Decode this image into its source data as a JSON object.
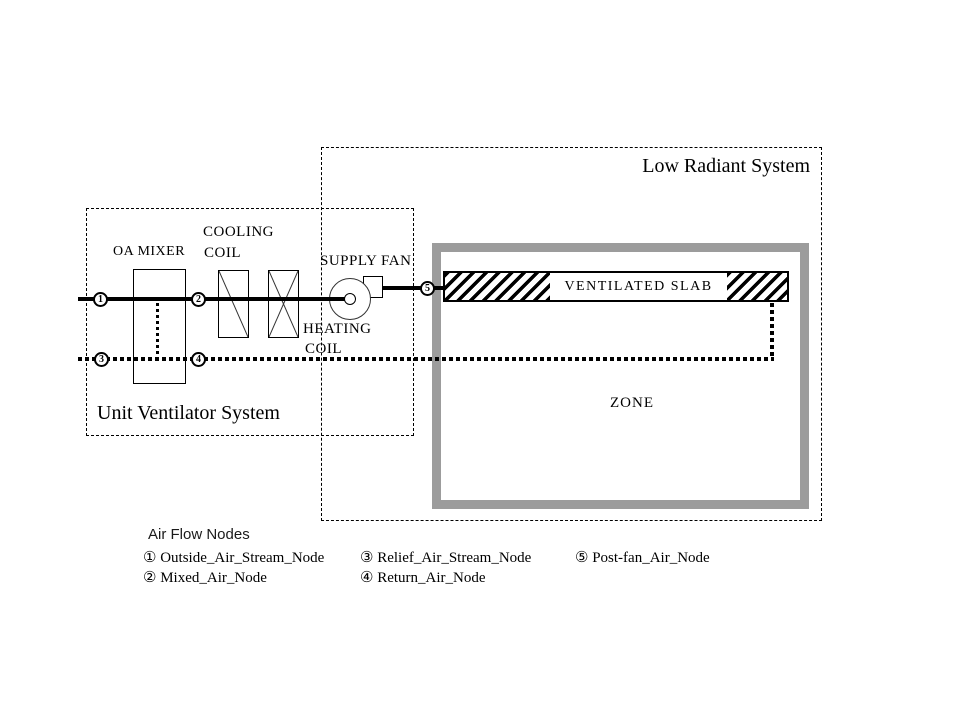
{
  "diagram": {
    "low_radiant_title": "Low Radiant System",
    "unit_ventilator_title": "Unit Ventilator System",
    "labels": {
      "oa_mixer": "OA MIXER",
      "cooling_line1": "COOLING",
      "cooling_line2": "COIL",
      "heating_line1": "HEATING",
      "heating_line2": "COIL",
      "supply_fan": "SUPPLY FAN",
      "ventilated_slab": "VENTILATED SLAB",
      "zone": "ZONE"
    },
    "nodes": [
      "1",
      "2",
      "3",
      "4",
      "5"
    ]
  },
  "legend": {
    "title": "Air Flow Nodes",
    "items": [
      "① Outside_Air_Stream_Node",
      "② Mixed_Air_Node",
      "③ Relief_Air_Stream_Node",
      "④ Return_Air_Node",
      "⑤ Post-fan_Air_Node"
    ]
  },
  "colors": {
    "line": "#000000",
    "zone_border": "#9c9c9c",
    "background": "#ffffff"
  }
}
